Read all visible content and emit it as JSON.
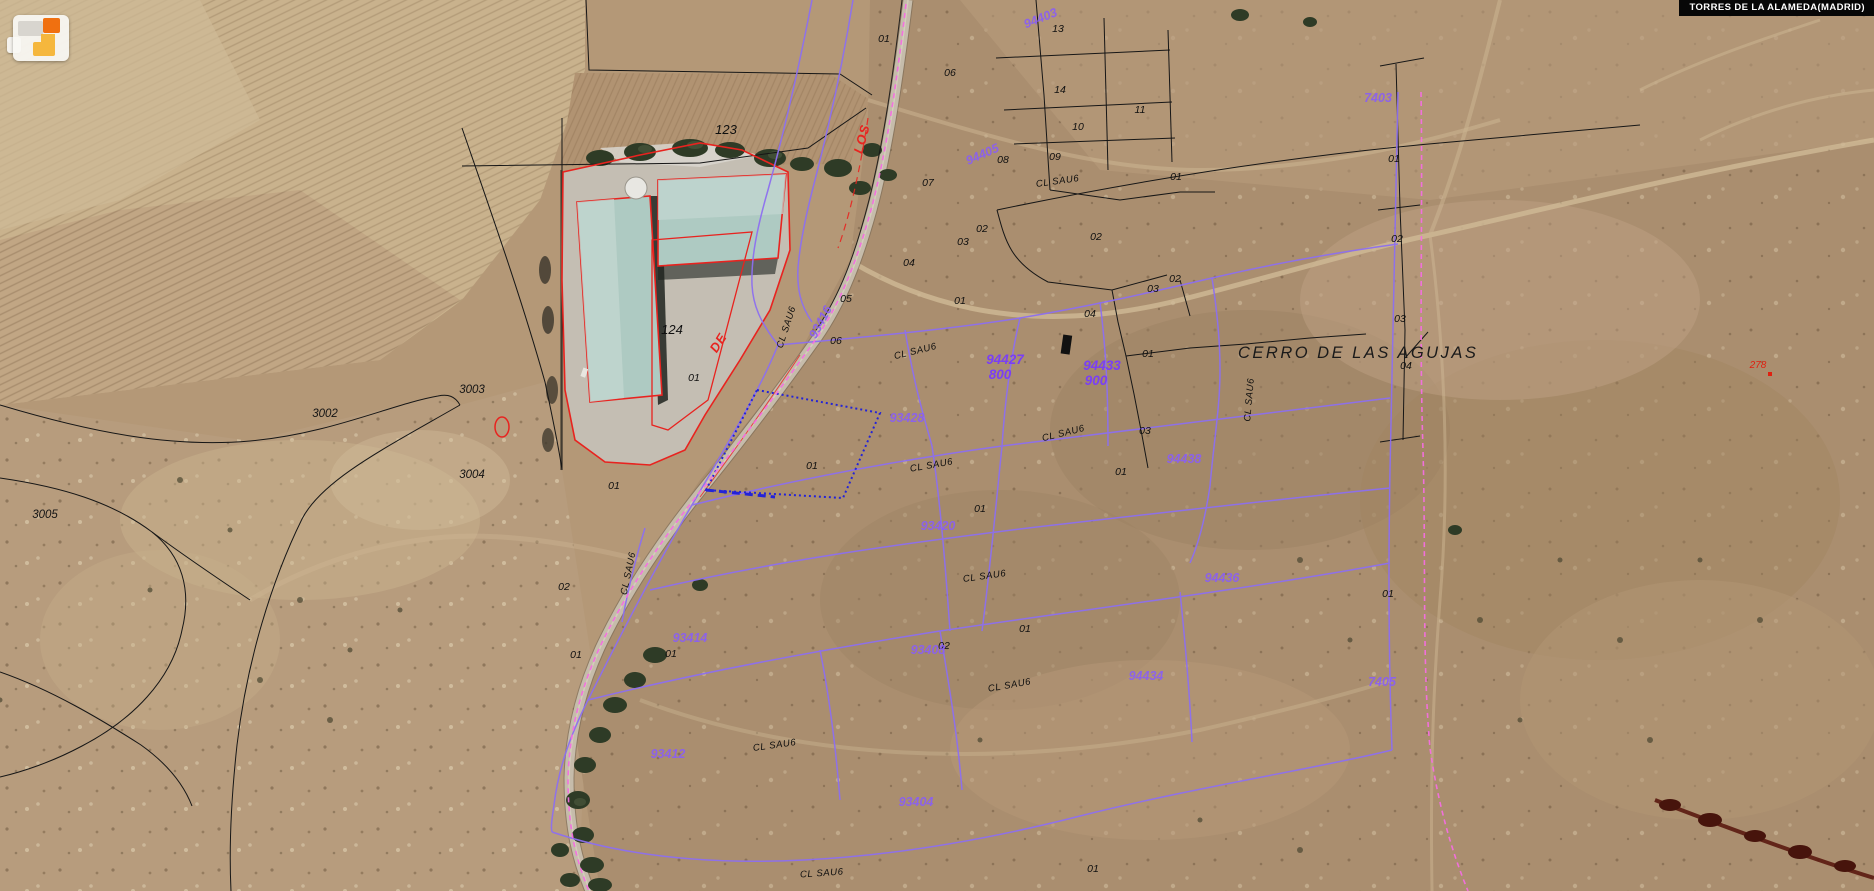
{
  "app": {
    "municipality_label": "TORRES DE LA ALAMEDA(MADRID)"
  },
  "colors": {
    "accent_red": "#e8231f",
    "cadastral_black": "#161616",
    "sector_purple": "#8d6ff0",
    "sector_purple_text": "#8a5ff2",
    "boundary_pink": "#f46ee0",
    "selection_blue": "#2323d8",
    "roof_teal": "#aecac2",
    "logo_orange": "#f07010",
    "logo_yellow": "#f5b73d"
  },
  "map": {
    "place_name": "CERRO DE LAS AGUJAS",
    "labels": [
      {
        "n": "place-name",
        "t": "CERRO DE LAS AGUJAS",
        "x": 1238,
        "y": 358,
        "r": 0,
        "c": "place"
      },
      {
        "n": "parcel-number",
        "t": "123",
        "x": 726,
        "y": 134,
        "r": 0,
        "c": "numlg"
      },
      {
        "n": "parcel-number",
        "t": "124",
        "x": 672,
        "y": 334,
        "r": 0,
        "c": "numlg"
      },
      {
        "n": "rustic-parcel-number",
        "t": "3002",
        "x": 325,
        "y": 417,
        "r": 0,
        "c": "rustic"
      },
      {
        "n": "rustic-parcel-number",
        "t": "3003",
        "x": 472,
        "y": 393,
        "r": 0,
        "c": "rustic"
      },
      {
        "n": "rustic-parcel-number",
        "t": "3004",
        "x": 472,
        "y": 478,
        "r": 0,
        "c": "rustic"
      },
      {
        "n": "rustic-parcel-number",
        "t": "3005",
        "x": 45,
        "y": 518,
        "r": 0,
        "c": "rustic"
      },
      {
        "n": "street-name-fragment",
        "t": "DE",
        "x": 722,
        "y": 345,
        "r": -58,
        "c": "redname"
      },
      {
        "n": "street-name-fragment",
        "t": "LOS",
        "x": 866,
        "y": 140,
        "r": -75,
        "c": "redname"
      },
      {
        "n": "red-parcel-number",
        "t": "278",
        "x": 1758,
        "y": 368,
        "r": 0,
        "c": "rednum"
      },
      {
        "n": "parcel-number",
        "t": "01",
        "x": 884,
        "y": 42,
        "r": 0,
        "c": "num"
      },
      {
        "n": "parcel-number",
        "t": "06",
        "x": 950,
        "y": 76,
        "r": 0,
        "c": "num"
      },
      {
        "n": "parcel-number",
        "t": "13",
        "x": 1058,
        "y": 32,
        "r": 0,
        "c": "num"
      },
      {
        "n": "parcel-number",
        "t": "14",
        "x": 1060,
        "y": 93,
        "r": 0,
        "c": "num"
      },
      {
        "n": "parcel-number",
        "t": "10",
        "x": 1078,
        "y": 130,
        "r": 0,
        "c": "num"
      },
      {
        "n": "parcel-number",
        "t": "11",
        "x": 1140,
        "y": 113,
        "r": 0,
        "c": "num"
      },
      {
        "n": "parcel-number",
        "t": "08",
        "x": 1003,
        "y": 163,
        "r": 0,
        "c": "num"
      },
      {
        "n": "parcel-number",
        "t": "09",
        "x": 1055,
        "y": 160,
        "r": 0,
        "c": "num"
      },
      {
        "n": "parcel-number",
        "t": "07",
        "x": 928,
        "y": 186,
        "r": 0,
        "c": "num"
      },
      {
        "n": "parcel-number",
        "t": "01",
        "x": 1176,
        "y": 180,
        "r": 0,
        "c": "num"
      },
      {
        "n": "parcel-number",
        "t": "02",
        "x": 1096,
        "y": 240,
        "r": 0,
        "c": "num"
      },
      {
        "n": "parcel-number",
        "t": "02",
        "x": 982,
        "y": 232,
        "r": 0,
        "c": "num"
      },
      {
        "n": "parcel-number",
        "t": "03",
        "x": 963,
        "y": 245,
        "r": 0,
        "c": "num"
      },
      {
        "n": "parcel-number",
        "t": "04",
        "x": 909,
        "y": 266,
        "r": 0,
        "c": "num"
      },
      {
        "n": "parcel-number",
        "t": "05",
        "x": 846,
        "y": 302,
        "r": 0,
        "c": "num"
      },
      {
        "n": "parcel-number",
        "t": "06",
        "x": 836,
        "y": 344,
        "r": 0,
        "c": "num"
      },
      {
        "n": "parcel-number",
        "t": "01",
        "x": 960,
        "y": 304,
        "r": 0,
        "c": "num"
      },
      {
        "n": "parcel-number",
        "t": "01",
        "x": 1148,
        "y": 357,
        "r": 0,
        "c": "num"
      },
      {
        "n": "parcel-number",
        "t": "02",
        "x": 1175,
        "y": 282,
        "r": 0,
        "c": "num"
      },
      {
        "n": "parcel-number",
        "t": "03",
        "x": 1153,
        "y": 292,
        "r": 0,
        "c": "num"
      },
      {
        "n": "parcel-number",
        "t": "04",
        "x": 1090,
        "y": 317,
        "r": 0,
        "c": "num"
      },
      {
        "n": "parcel-number",
        "t": "03",
        "x": 1145,
        "y": 434,
        "r": 0,
        "c": "num"
      },
      {
        "n": "parcel-number",
        "t": "04",
        "x": 1406,
        "y": 369,
        "r": 0,
        "c": "num"
      },
      {
        "n": "parcel-number",
        "t": "03",
        "x": 1400,
        "y": 322,
        "r": 0,
        "c": "num"
      },
      {
        "n": "parcel-number",
        "t": "02",
        "x": 1397,
        "y": 242,
        "r": 0,
        "c": "num"
      },
      {
        "n": "parcel-number",
        "t": "01",
        "x": 1394,
        "y": 162,
        "r": 0,
        "c": "num"
      },
      {
        "n": "parcel-number",
        "t": "01",
        "x": 694,
        "y": 381,
        "r": 0,
        "c": "num"
      },
      {
        "n": "parcel-number",
        "t": "01",
        "x": 614,
        "y": 489,
        "r": 0,
        "c": "num"
      },
      {
        "n": "parcel-number",
        "t": "02",
        "x": 564,
        "y": 590,
        "r": 0,
        "c": "num"
      },
      {
        "n": "parcel-number",
        "t": "01",
        "x": 812,
        "y": 469,
        "r": 0,
        "c": "num"
      },
      {
        "n": "parcel-number",
        "t": "01",
        "x": 1121,
        "y": 475,
        "r": 0,
        "c": "num"
      },
      {
        "n": "parcel-number",
        "t": "01",
        "x": 980,
        "y": 512,
        "r": 0,
        "c": "num"
      },
      {
        "n": "parcel-number",
        "t": "01",
        "x": 671,
        "y": 657,
        "r": 0,
        "c": "num"
      },
      {
        "n": "parcel-number",
        "t": "01",
        "x": 576,
        "y": 658,
        "r": 0,
        "c": "num"
      },
      {
        "n": "parcel-number",
        "t": "01",
        "x": 1025,
        "y": 632,
        "r": 0,
        "c": "num"
      },
      {
        "n": "parcel-number",
        "t": "02",
        "x": 944,
        "y": 649,
        "r": 0,
        "c": "num"
      },
      {
        "n": "parcel-number",
        "t": "01",
        "x": 1388,
        "y": 597,
        "r": 0,
        "c": "num"
      },
      {
        "n": "parcel-number",
        "t": "01",
        "x": 1093,
        "y": 872,
        "r": 0,
        "c": "num"
      },
      {
        "n": "street-label",
        "t": "CL  SAU6",
        "x": 789,
        "y": 328,
        "r": -72,
        "c": "street"
      },
      {
        "n": "street-label",
        "t": "CL  SAU6",
        "x": 916,
        "y": 354,
        "r": -14,
        "c": "street"
      },
      {
        "n": "street-label",
        "t": "CL  SAU6",
        "x": 1058,
        "y": 184,
        "r": -8,
        "c": "street"
      },
      {
        "n": "street-label",
        "t": "CL  SAU6",
        "x": 1252,
        "y": 400,
        "r": -85,
        "c": "street"
      },
      {
        "n": "street-label",
        "t": "CL  SAU6",
        "x": 932,
        "y": 468,
        "r": -10,
        "c": "street"
      },
      {
        "n": "street-label",
        "t": "CL  SAU6",
        "x": 1064,
        "y": 436,
        "r": -14,
        "c": "street"
      },
      {
        "n": "street-label",
        "t": "CL  SAU6",
        "x": 631,
        "y": 574,
        "r": -78,
        "c": "street"
      },
      {
        "n": "street-label",
        "t": "CL  SAU6",
        "x": 985,
        "y": 579,
        "r": -8,
        "c": "street"
      },
      {
        "n": "street-label",
        "t": "CL  SAU6",
        "x": 1010,
        "y": 688,
        "r": -10,
        "c": "street"
      },
      {
        "n": "street-label",
        "t": "CL  SAU6",
        "x": 822,
        "y": 876,
        "r": -4,
        "c": "street"
      },
      {
        "n": "street-label",
        "t": "CL  SAU6",
        "x": 775,
        "y": 748,
        "r": -8,
        "c": "street"
      },
      {
        "n": "sector-code",
        "t": "94403",
        "x": 1042,
        "y": 22,
        "r": -22,
        "c": "pcode"
      },
      {
        "n": "sector-code",
        "t": "94405",
        "x": 984,
        "y": 158,
        "r": -24,
        "c": "pcode"
      },
      {
        "n": "sector-code",
        "t": "93416",
        "x": 824,
        "y": 324,
        "r": -62,
        "c": "pcode"
      },
      {
        "n": "sector-code",
        "t": "93428",
        "x": 907,
        "y": 422,
        "r": 0,
        "c": "pcode"
      },
      {
        "n": "sector-code",
        "t": "94438",
        "x": 1184,
        "y": 463,
        "r": 0,
        "c": "pcode"
      },
      {
        "n": "sector-code",
        "t": "93420",
        "x": 938,
        "y": 530,
        "r": 0,
        "c": "pcode"
      },
      {
        "n": "sector-code",
        "t": "94436",
        "x": 1222,
        "y": 582,
        "r": 0,
        "c": "pcode"
      },
      {
        "n": "sector-code",
        "t": "93414",
        "x": 690,
        "y": 642,
        "r": 0,
        "c": "pcode"
      },
      {
        "n": "sector-code",
        "t": "93408",
        "x": 928,
        "y": 654,
        "r": 0,
        "c": "pcode"
      },
      {
        "n": "sector-code",
        "t": "94434",
        "x": 1146,
        "y": 680,
        "r": 0,
        "c": "pcode"
      },
      {
        "n": "sector-code",
        "t": "7405",
        "x": 1382,
        "y": 686,
        "r": 0,
        "c": "pcode"
      },
      {
        "n": "sector-code",
        "t": "7403",
        "x": 1378,
        "y": 102,
        "r": 0,
        "c": "pcode"
      },
      {
        "n": "sector-code",
        "t": "93412",
        "x": 668,
        "y": 758,
        "r": 0,
        "c": "pcode"
      },
      {
        "n": "sector-code",
        "t": "93404",
        "x": 916,
        "y": 806,
        "r": 0,
        "c": "pcode"
      },
      {
        "n": "finca-code",
        "t": "94433",
        "x": 1102,
        "y": 370,
        "r": 0,
        "c": "pcodeb"
      },
      {
        "n": "finca-code",
        "t": "900",
        "x": 1096,
        "y": 385,
        "r": 0,
        "c": "pcodeb"
      },
      {
        "n": "finca-code",
        "t": "94427",
        "x": 1005,
        "y": 364,
        "r": 0,
        "c": "pcodeb"
      },
      {
        "n": "finca-code",
        "t": "800",
        "x": 1000,
        "y": 379,
        "r": 0,
        "c": "pcodeb"
      }
    ]
  }
}
